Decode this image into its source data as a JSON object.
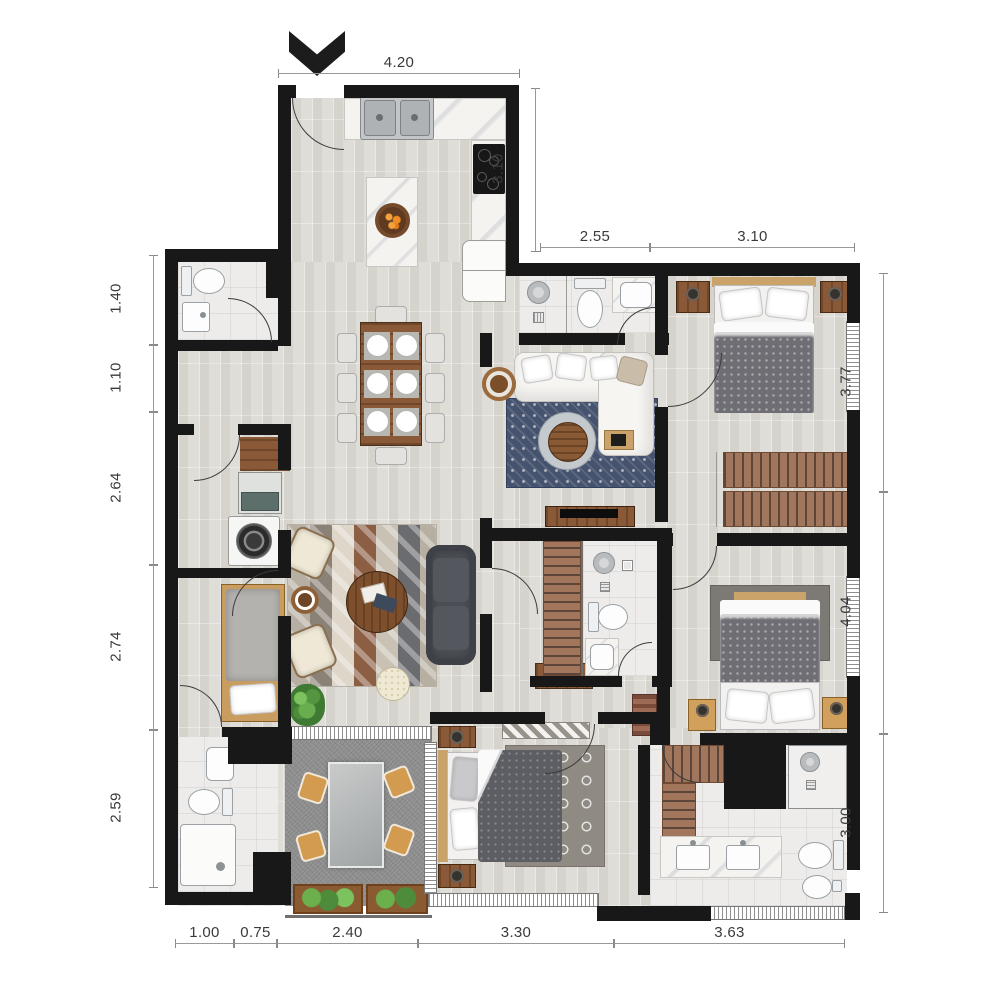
{
  "meta": {
    "type": "apartment-floor-plan"
  },
  "dims": {
    "top_width": "4.20",
    "kitchen_depth": "3.10",
    "bath_hall_width": "2.55",
    "bedroom1_width": "3.10",
    "left": [
      "1.40",
      "1.10",
      "2.64",
      "2.74",
      "2.59"
    ],
    "right": [
      "3.77",
      "4.04",
      "3.00"
    ],
    "bottom": [
      "1.00",
      "0.75",
      "2.40",
      "3.30",
      "3.63"
    ]
  },
  "icons": {
    "entry": "chevron-down-arrow"
  },
  "colors": {
    "wall": "#181818",
    "floor": "#e4e2dd",
    "wood": "#8a5a38",
    "rug_blue": "#46536e",
    "sofa_gray": "#4b4e54",
    "cream": "#efe8d6",
    "plant": "#4e9347",
    "balcony": "#8f8f8f",
    "dim_text": "#3a3a3a"
  }
}
